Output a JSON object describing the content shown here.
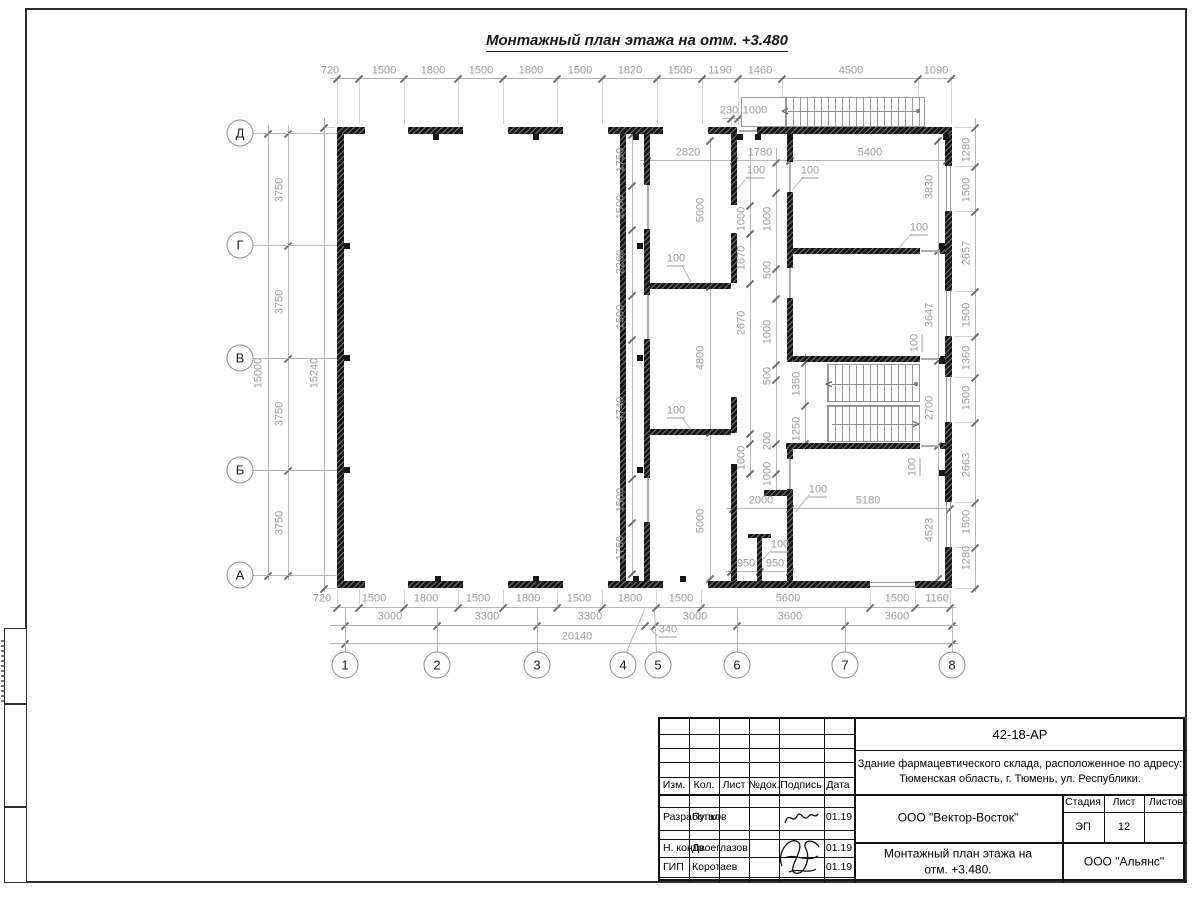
{
  "sheet": {
    "plan_title": "Монтажный план этажа на отм. +3.480"
  },
  "axes": {
    "rows": [
      {
        "label": "Д",
        "y": 133
      },
      {
        "label": "Г",
        "y": 245
      },
      {
        "label": "В",
        "y": 358
      },
      {
        "label": "Б",
        "y": 470
      },
      {
        "label": "А",
        "y": 575
      }
    ],
    "cols": [
      {
        "label": "1",
        "x": 345
      },
      {
        "label": "2",
        "x": 437
      },
      {
        "label": "3",
        "x": 537
      },
      {
        "label": "4",
        "x": 623,
        "nc": 1
      },
      {
        "label": "5",
        "x": 658,
        "nc": 1
      },
      {
        "label": "6",
        "x": 737
      },
      {
        "label": "7",
        "x": 845
      },
      {
        "label": "8",
        "x": 952
      }
    ]
  },
  "plan": {
    "walls": [
      [
        337,
        127,
        28,
        7
      ],
      [
        408,
        127,
        55,
        7
      ],
      [
        508,
        127,
        55,
        7
      ],
      [
        608,
        127,
        55,
        7
      ],
      [
        708,
        127,
        29,
        7
      ],
      [
        757,
        127,
        195,
        7
      ],
      [
        337,
        581,
        28,
        7
      ],
      [
        408,
        581,
        55,
        7
      ],
      [
        508,
        581,
        55,
        7
      ],
      [
        608,
        581,
        55,
        7
      ],
      [
        708,
        581,
        162,
        7
      ],
      [
        915,
        581,
        37,
        7
      ],
      [
        337,
        134,
        7,
        447
      ],
      [
        945,
        134,
        7,
        32
      ],
      [
        945,
        211,
        7,
        80
      ],
      [
        945,
        336,
        7,
        41
      ],
      [
        945,
        422,
        7,
        80
      ],
      [
        945,
        547,
        7,
        34
      ],
      [
        620,
        134,
        6,
        447
      ],
      [
        644,
        134,
        6,
        51
      ],
      [
        644,
        229,
        6,
        66
      ],
      [
        644,
        339,
        6,
        139
      ],
      [
        644,
        522,
        6,
        59
      ],
      [
        731,
        134,
        6,
        71
      ],
      [
        731,
        233,
        6,
        50
      ],
      [
        731,
        397,
        6,
        36
      ],
      [
        731,
        470,
        6,
        111
      ],
      [
        787,
        134,
        6,
        28
      ],
      [
        787,
        192,
        6,
        76
      ],
      [
        787,
        298,
        6,
        64
      ],
      [
        787,
        443,
        6,
        16
      ],
      [
        787,
        489,
        6,
        92
      ],
      [
        650,
        283,
        81,
        6
      ],
      [
        650,
        429,
        81,
        6
      ],
      [
        793,
        248,
        127,
        6
      ],
      [
        940,
        248,
        5,
        6
      ],
      [
        793,
        356,
        127,
        6
      ],
      [
        940,
        356,
        5,
        6
      ],
      [
        786,
        443,
        134,
        6
      ],
      [
        940,
        443,
        5,
        6
      ],
      [
        764,
        490,
        26,
        6
      ],
      [
        757,
        538,
        5,
        43
      ],
      [
        748,
        534,
        23,
        4
      ]
    ],
    "windows": [
      [
        946,
        166,
        5,
        45,
        1
      ],
      [
        946,
        291,
        5,
        45,
        1
      ],
      [
        946,
        377,
        5,
        45,
        1
      ],
      [
        946,
        502,
        5,
        45,
        1
      ],
      [
        870,
        582,
        45,
        5,
        0
      ]
    ],
    "door_lines": [
      [
        647,
        185,
        2,
        44
      ],
      [
        647,
        295,
        2,
        44
      ],
      [
        647,
        478,
        2,
        44
      ],
      [
        789,
        162,
        2,
        30
      ],
      [
        789,
        268,
        2,
        30
      ],
      [
        789,
        459,
        2,
        30
      ],
      [
        921,
        358,
        19,
        2
      ],
      [
        921,
        250,
        19,
        2
      ],
      [
        921,
        445,
        19,
        2
      ],
      [
        739,
        130,
        18,
        2
      ]
    ],
    "tabs": [
      [
        433,
        134
      ],
      [
        533,
        134
      ],
      [
        633,
        134
      ],
      [
        737,
        134
      ],
      [
        755,
        134
      ],
      [
        787,
        134
      ],
      [
        943,
        134
      ],
      [
        435,
        576
      ],
      [
        533,
        576
      ],
      [
        633,
        576
      ],
      [
        680,
        576
      ],
      [
        344,
        243
      ],
      [
        344,
        355
      ],
      [
        344,
        467
      ],
      [
        637,
        243
      ],
      [
        637,
        355
      ],
      [
        637,
        467
      ],
      [
        939,
        243
      ],
      [
        939,
        358
      ],
      [
        939,
        470
      ],
      [
        731,
        464
      ]
    ],
    "dim_lines_h": [
      {
        "y": 78,
        "x1": 330,
        "x2": 956,
        "t": [
          337,
          359,
          404,
          458,
          503,
          557,
          602,
          657,
          702,
          738,
          782,
          918,
          951
        ],
        "e": 46
      },
      {
        "y": 118,
        "x1": 722,
        "x2": 796,
        "t": [
          731,
          738,
          768
        ],
        "e": 7
      },
      {
        "y": 160,
        "x1": 640,
        "x2": 950,
        "t": [
          647,
          734,
          790,
          947
        ],
        "e": -24
      },
      {
        "y": 508,
        "x1": 726,
        "x2": 952,
        "t": [
          733,
          790,
          950
        ],
        "e": 0
      },
      {
        "y": 571,
        "x1": 726,
        "x2": 795,
        "t": [
          731,
          760,
          790
        ],
        "e": 0
      },
      {
        "y": 607,
        "x1": 330,
        "x2": 956,
        "t": [
          337,
          359,
          404,
          458,
          503,
          557,
          602,
          656,
          701,
          870,
          915,
          950
        ],
        "e": -17
      },
      {
        "y": 625,
        "x1": 330,
        "x2": 958,
        "t": [
          345,
          437,
          537,
          645,
          655,
          737,
          845,
          952
        ],
        "e": 0
      },
      {
        "y": 643,
        "x1": 330,
        "x2": 958,
        "t": [
          345,
          952
        ],
        "e": 0
      }
    ],
    "dim_lines_v": [
      {
        "x": 268,
        "y1": 125,
        "y2": 580,
        "t": [
          133,
          575
        ],
        "e": 0
      },
      {
        "x": 288,
        "y1": 125,
        "y2": 580,
        "t": [
          133,
          245,
          358,
          470,
          575
        ],
        "e": 46
      },
      {
        "x": 324,
        "y1": 118,
        "y2": 592,
        "t": [
          127,
          588
        ],
        "e": 11
      },
      {
        "x": 975,
        "y1": 118,
        "y2": 592,
        "t": [
          127,
          166,
          211,
          291,
          336,
          377,
          422,
          502,
          547,
          588
        ],
        "e": -21
      },
      {
        "x": 632,
        "y1": 134,
        "y2": 576,
        "t": [
          134,
          185,
          229,
          295,
          339,
          478,
          522,
          573
        ],
        "e": 0
      },
      {
        "x": 710,
        "y1": 138,
        "y2": 578,
        "t": [
          140,
          286,
          432,
          578
        ],
        "e": 0
      },
      {
        "x": 750,
        "y1": 148,
        "y2": 478,
        "t": [
          205,
          233,
          283,
          433,
          443,
          473
        ],
        "e": 0
      },
      {
        "x": 776,
        "y1": 148,
        "y2": 496,
        "t": [
          162,
          192,
          268,
          298,
          364,
          379,
          443,
          473
        ],
        "e": 0
      },
      {
        "x": 805,
        "y1": 354,
        "y2": 450,
        "t": [
          362,
          405,
          443
        ],
        "e": 0
      },
      {
        "x": 938,
        "y1": 138,
        "y2": 578,
        "t": [
          140,
          250,
          360,
          445,
          578
        ],
        "e": 0
      }
    ],
    "dim_labels": [
      [
        "720",
        330,
        71,
        0,
        0
      ],
      [
        "1500",
        384,
        71,
        0,
        0
      ],
      [
        "1800",
        433,
        71,
        0,
        0
      ],
      [
        "1500",
        481,
        71,
        0,
        0
      ],
      [
        "1800",
        531,
        71,
        0,
        0
      ],
      [
        "1500",
        580,
        71,
        0,
        0
      ],
      [
        "1820",
        630,
        71,
        0,
        0
      ],
      [
        "1500",
        680,
        71,
        0,
        0
      ],
      [
        "1190",
        720,
        71,
        0,
        0
      ],
      [
        "1460",
        760,
        71,
        0,
        0
      ],
      [
        "4500",
        851,
        71,
        0,
        0
      ],
      [
        "1090",
        936,
        71,
        0,
        0
      ],
      [
        "230",
        729,
        111,
        0,
        0
      ],
      [
        "1000",
        755,
        111,
        0,
        0
      ],
      [
        "2820",
        688,
        153,
        0,
        0
      ],
      [
        "1780",
        760,
        153,
        0,
        0
      ],
      [
        "5400",
        870,
        153,
        0,
        0
      ],
      [
        "100",
        756,
        172,
        0,
        1
      ],
      [
        "100",
        810,
        172,
        0,
        1
      ],
      [
        "100",
        919,
        229,
        0,
        1
      ],
      [
        "2000",
        761,
        501,
        0,
        0
      ],
      [
        "5180",
        868,
        501,
        0,
        0
      ],
      [
        "100",
        818,
        491,
        0,
        1
      ],
      [
        "100",
        780,
        546,
        0,
        1
      ],
      [
        "950",
        746,
        564,
        0,
        0
      ],
      [
        "950",
        775,
        564,
        0,
        0
      ],
      [
        "720",
        322,
        599,
        0,
        0
      ],
      [
        "1500",
        374,
        599,
        0,
        0
      ],
      [
        "1800",
        426,
        599,
        0,
        0
      ],
      [
        "1500",
        478,
        599,
        0,
        0
      ],
      [
        "1800",
        528,
        599,
        0,
        0
      ],
      [
        "1500",
        579,
        599,
        0,
        0
      ],
      [
        "1800",
        630,
        599,
        0,
        0
      ],
      [
        "1500",
        681,
        599,
        0,
        0
      ],
      [
        "5600",
        788,
        599,
        0,
        0
      ],
      [
        "1500",
        897,
        599,
        0,
        0
      ],
      [
        "1160",
        937,
        599,
        0,
        0
      ],
      [
        "3000",
        390,
        617,
        0,
        0
      ],
      [
        "3300",
        487,
        617,
        0,
        0
      ],
      [
        "3300",
        590,
        617,
        0,
        0
      ],
      [
        "3000",
        695,
        617,
        0,
        0
      ],
      [
        "3600",
        790,
        617,
        0,
        0
      ],
      [
        "3600",
        897,
        617,
        0,
        0
      ],
      [
        "340",
        668,
        631,
        0,
        1
      ],
      [
        "20140",
        577,
        637,
        0,
        0
      ],
      [
        "15000",
        259,
        373,
        1,
        0
      ],
      [
        "3750",
        280,
        190,
        1,
        0
      ],
      [
        "3750",
        280,
        302,
        1,
        0
      ],
      [
        "3750",
        280,
        414,
        1,
        0
      ],
      [
        "3750",
        280,
        523,
        1,
        0
      ],
      [
        "15240",
        315,
        373,
        1,
        0
      ],
      [
        "1280",
        967,
        150,
        1,
        0
      ],
      [
        "1500",
        967,
        190,
        1,
        0
      ],
      [
        "2657",
        967,
        253,
        1,
        0
      ],
      [
        "1500",
        967,
        315,
        1,
        0
      ],
      [
        "1360",
        967,
        358,
        1,
        0
      ],
      [
        "1500",
        967,
        398,
        1,
        0
      ],
      [
        "2663",
        967,
        465,
        1,
        0
      ],
      [
        "1500",
        967,
        522,
        1,
        0
      ],
      [
        "1280",
        967,
        558,
        1,
        0
      ],
      [
        "1750",
        621,
        160,
        1,
        0
      ],
      [
        "1500",
        621,
        207,
        1,
        0
      ],
      [
        "2260",
        621,
        262,
        1,
        0
      ],
      [
        "1500",
        621,
        317,
        1,
        0
      ],
      [
        "4740",
        621,
        409,
        1,
        0
      ],
      [
        "1500",
        621,
        500,
        1,
        0
      ],
      [
        "1750",
        621,
        548,
        1,
        0
      ],
      [
        "5000",
        701,
        210,
        1,
        0
      ],
      [
        "4800",
        701,
        358,
        1,
        0
      ],
      [
        "5000",
        701,
        521,
        1,
        0
      ],
      [
        "1000",
        742,
        219,
        1,
        0
      ],
      [
        "1670",
        742,
        258,
        1,
        0
      ],
      [
        "2670",
        742,
        323,
        1,
        0
      ],
      [
        "1000",
        742,
        458,
        1,
        0
      ],
      [
        "1000",
        768,
        219,
        1,
        0
      ],
      [
        "500",
        768,
        270,
        1,
        0
      ],
      [
        "1000",
        768,
        332,
        1,
        0
      ],
      [
        "500",
        768,
        376,
        1,
        0
      ],
      [
        "200",
        768,
        441,
        1,
        0
      ],
      [
        "1000",
        768,
        474,
        1,
        0
      ],
      [
        "1350",
        797,
        384,
        1,
        0
      ],
      [
        "1250",
        797,
        429,
        1,
        0
      ],
      [
        "3830",
        930,
        187,
        1,
        0
      ],
      [
        "3647",
        930,
        315,
        1,
        0
      ],
      [
        "2700",
        930,
        408,
        1,
        0
      ],
      [
        "4523",
        930,
        530,
        1,
        0
      ],
      [
        "100",
        916,
        343,
        1,
        1
      ],
      [
        "100",
        914,
        467,
        1,
        1
      ],
      [
        "100",
        676,
        260,
        0,
        1
      ],
      [
        "100",
        676,
        412,
        0,
        1
      ]
    ],
    "leader_lines": [
      [
        645,
        610,
        627,
        652
      ],
      [
        655,
        610,
        657,
        652
      ],
      [
        650,
        628,
        658,
        636
      ],
      [
        748,
        177,
        737,
        190
      ],
      [
        804,
        177,
        793,
        190
      ],
      [
        912,
        234,
        898,
        250
      ],
      [
        810,
        495,
        796,
        512
      ],
      [
        772,
        550,
        761,
        562
      ],
      [
        683,
        266,
        692,
        283
      ],
      [
        683,
        418,
        692,
        430
      ]
    ],
    "stairs": {
      "external": {
        "outline": [
          741,
          97,
          184,
          30
        ],
        "treads": [
          785,
          97,
          135,
          30
        ],
        "line": [
          788,
          111,
          131
        ],
        "arrow": [
          "<",
          785,
          111
        ],
        "dot": [
          916,
          109
        ]
      },
      "internal": {
        "upper": [
          827,
          364,
          93,
          39
        ],
        "divider": [
          827,
          401,
          93,
          5
        ],
        "lower": [
          827,
          406,
          93,
          36
        ],
        "lines": [
          [
            832,
            384,
            84
          ],
          [
            832,
            424,
            84
          ]
        ],
        "arrows": [
          [
            "<",
            829,
            384
          ],
          [
            ">",
            916,
            424
          ]
        ],
        "dots": [
          [
            914,
            382
          ]
        ]
      }
    }
  },
  "title_block": {
    "doc_number": "42-18-АР",
    "project_desc_1": "Здание фармацевтического склада, расположенное по адресу:",
    "project_desc_2": "Тюменская область, г. Тюмень, ул. Республики.",
    "col_izm": "Изм.",
    "col_kol": "Кол.",
    "col_list": "Лист",
    "col_ndok": "№док.",
    "col_podpis": "Подпись",
    "col_data": "Дата",
    "row1_role": "Разработал",
    "row1_name": "Пупков",
    "row1_date": "01.19",
    "row2_role": "Н. контр.",
    "row2_name": "Двоеглазов",
    "row2_date": "01.19",
    "row3_role": "ГИП",
    "row3_name": "Коротаев",
    "row3_date": "01.19",
    "company": "ООО \"Вектор-Восток\"",
    "stage_label": "Стадия",
    "sheet_label": "Лист",
    "sheets_label": "Листов",
    "stage_value": "ЭП",
    "sheet_value": "12",
    "drawing_title_1": "Монтажный план этажа на",
    "drawing_title_2": "отм. +3.480.",
    "org": "ООО \"Альянс\""
  }
}
